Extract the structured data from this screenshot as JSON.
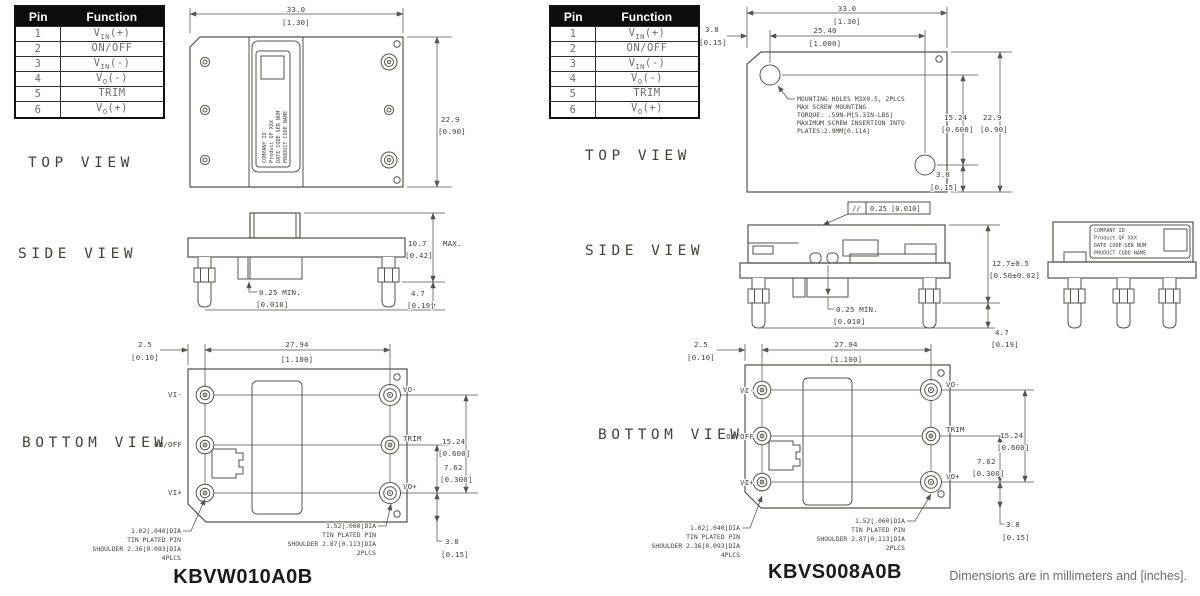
{
  "footer_note": "Dimensions are in millimeters and [inches].",
  "view_labels": {
    "top": "TOP VIEW",
    "side": "SIDE VIEW",
    "bottom": "BOTTOM VIEW"
  },
  "module_label": {
    "l1": "COMPANY ID",
    "l2": "Product QF XXX",
    "l3": "DATE CODE-SER NUM",
    "l4": "PRODUCT CODE NAME"
  },
  "pin_table": {
    "pin_header": "Pin",
    "function_header": "Function",
    "rows": [
      {
        "pin": "1",
        "pre": "V",
        "sub": "IN",
        "post": "(+)"
      },
      {
        "pin": "2",
        "pre": "ON/OFF",
        "sub": "",
        "post": ""
      },
      {
        "pin": "3",
        "pre": "V",
        "sub": "IN",
        "post": "(-)"
      },
      {
        "pin": "4",
        "pre": "V",
        "sub": "O",
        "post": "(-)"
      },
      {
        "pin": "5",
        "pre": "TRIM",
        "sub": "",
        "post": ""
      },
      {
        "pin": "6",
        "pre": "V",
        "sub": "O",
        "post": "(+)"
      }
    ]
  },
  "left": {
    "part_number": "KBVW010A0B",
    "top": {
      "w_mm": "33.0",
      "w_in": "[1.30]",
      "h_mm": "22.9",
      "h_in": "[0.90]"
    },
    "side": {
      "h_mm": "10.7",
      "h_max": "MAX.",
      "h_in": "[0.42]",
      "gap": "0.25 MIN.",
      "gap_in": "[0.010]",
      "pin_mm": "4.7",
      "pin_in": "[0.19]"
    },
    "bottom": {
      "off_mm": "2.5",
      "off_in": "[0.10]",
      "pitch_mm": "27.94",
      "pitch_in": "[1.100]",
      "span_mm": "15.24",
      "span_in": "[0.600]",
      "half_mm": "7.62",
      "half_in": "[0.300]",
      "edge_mm": "3.8",
      "edge_in": "[0.15]",
      "pins_left": [
        "VI-",
        "ON/OFF",
        "VI+"
      ],
      "pins_right": [
        "VO-",
        "TRIM",
        "VO+"
      ],
      "note_small": [
        "1.02[.040]DIA",
        "TIN PLATED PIN",
        "SHOULDER 2.36[0.093]DIA",
        "4PLCS"
      ],
      "note_large": [
        "1.52[.060]DIA",
        "TIN PLATED PIN",
        "SHOULDER 2.87[0.113]DIA",
        "2PLCS"
      ]
    }
  },
  "right": {
    "part_number": "KBVS008A0B",
    "top": {
      "w_mm": "33.0",
      "w_in": "[1.30]",
      "w2_mm": "25.40",
      "w2_in": "[1.000]",
      "off_mm": "3.8",
      "off_in": "[0.15]",
      "span_mm": "15.24",
      "span_in": "[0.600]",
      "h_mm": "22.9",
      "h_in": "[0.90]",
      "edge_mm": "3.8",
      "edge_in": "[0.15]",
      "mount_note": [
        "MOUNTING HOLES M3X0.5, 2PLCS",
        "MAX SCREW MOUNTING",
        "TORQUE: .59N-M[5.3IN-LBS]",
        "MAXIMUM SCREW INSERTION INTO",
        "PLATES:2.9MM[0.114]"
      ]
    },
    "side": {
      "flat_sym": "//",
      "flat_val": "0.25 [0.010]",
      "h_mm": "12.7±0.5",
      "h_in": "[0.50±0.02]",
      "gap": "0.25 MIN.",
      "gap_in": "[0.010]",
      "pin_mm": "4.7",
      "pin_in": "[0.19]"
    },
    "bottom": {
      "off_mm": "2.5",
      "off_in": "[0.10]",
      "pitch_mm": "27.94",
      "pitch_in": "[1.100]",
      "span_mm": "15.24",
      "span_in": "[0.600]",
      "half_mm": "7.62",
      "half_in": "[0.300]",
      "edge_mm": "3.8",
      "edge_in": "[0.15]",
      "pins_left": [
        "VI-",
        "ON/OFF",
        "VI+"
      ],
      "pins_right": [
        "VO-",
        "TRIM",
        "VO+"
      ],
      "note_small": [
        "1.02[.040]DIA",
        "TIN PLATED PIN",
        "SHOULDER 2.36[0.093]DIA",
        "4PLCS"
      ],
      "note_large": [
        "1.52[.060]DIA",
        "TIN PLATED PIN",
        "SHOULDER 2.87[0.113]DIA",
        "2PLCS"
      ]
    }
  }
}
